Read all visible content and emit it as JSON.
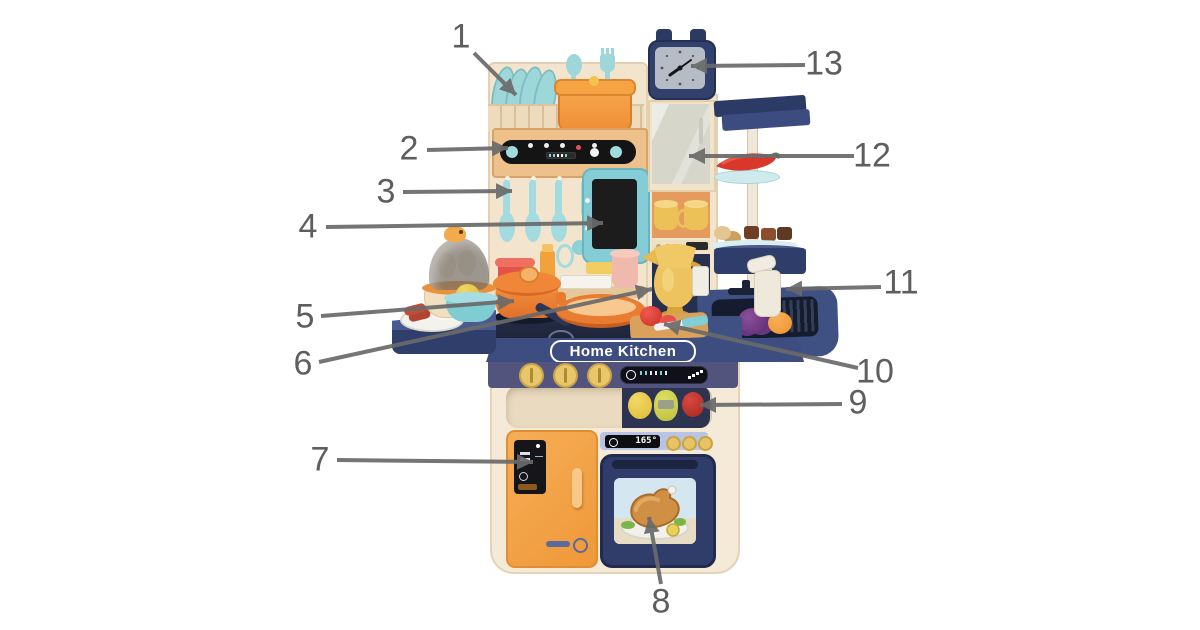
{
  "diagram": {
    "background_color": "#ffffff",
    "leader_line_color": "#6a6a6a",
    "number_color": "#5e5e5e"
  },
  "product": {
    "name_plate_text": "Home Kitchen",
    "oven_display_temp": "165°",
    "accent_colors": {
      "body_cream": "#f2e4cd",
      "navy_blue": "#35426e",
      "panel_purple": "#53547e",
      "accent_orange": "#f29a44",
      "toy_teal": "#9fd8dc",
      "gold_yellow": "#e9c464"
    }
  },
  "callouts": [
    {
      "number": "1",
      "target": "dish-rack-plates"
    },
    {
      "number": "2",
      "target": "hood-control-panel"
    },
    {
      "number": "3",
      "target": "hanging-utensils"
    },
    {
      "number": "4",
      "target": "play-screen"
    },
    {
      "number": "5",
      "target": "cooking-pot"
    },
    {
      "number": "6",
      "target": "cooktop-frying-pan"
    },
    {
      "number": "7",
      "target": "refrigerator-door"
    },
    {
      "number": "8",
      "target": "oven-with-chicken"
    },
    {
      "number": "9",
      "target": "fruit-compartment"
    },
    {
      "number": "10",
      "target": "cutting-board-set"
    },
    {
      "number": "11",
      "target": "soap-dispenser"
    },
    {
      "number": "12",
      "target": "storage-cabinet"
    },
    {
      "number": "13",
      "target": "clock"
    }
  ]
}
